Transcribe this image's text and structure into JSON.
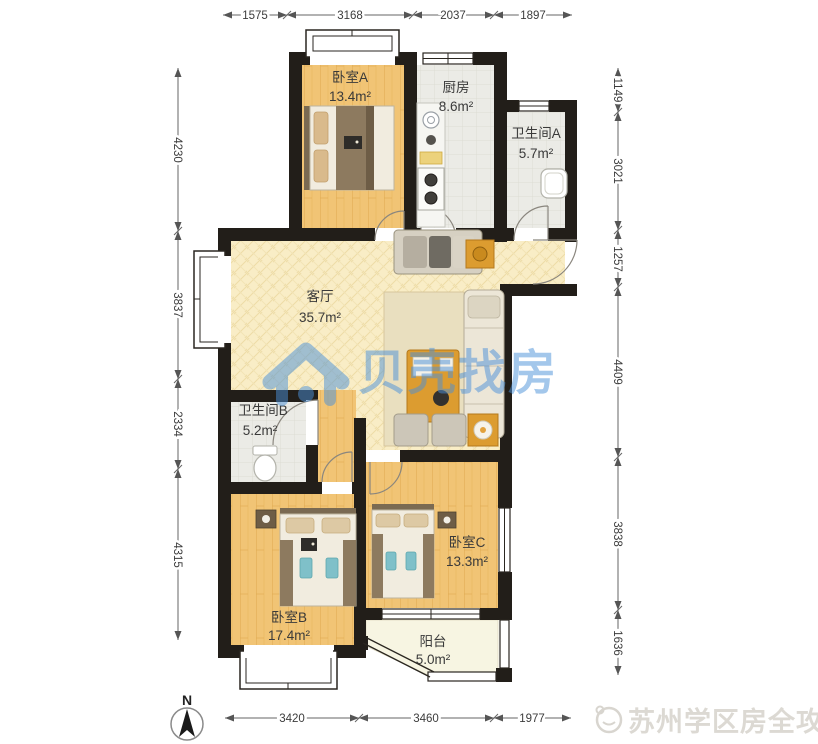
{
  "plan": {
    "rooms": [
      {
        "id": "bedroom-a",
        "name": "卧室A",
        "area": "13.4m²"
      },
      {
        "id": "kitchen",
        "name": "厨房",
        "area": "8.6m²"
      },
      {
        "id": "bathroom-a",
        "name": "卫生间A",
        "area": "5.7m²"
      },
      {
        "id": "living-room",
        "name": "客厅",
        "area": "35.7m²"
      },
      {
        "id": "bathroom-b",
        "name": "卫生间B",
        "area": "5.2m²"
      },
      {
        "id": "bedroom-b",
        "name": "卧室B",
        "area": "17.4m²"
      },
      {
        "id": "bedroom-c",
        "name": "卧室C",
        "area": "13.3m²"
      },
      {
        "id": "balcony",
        "name": "阳台",
        "area": "5.0m²"
      }
    ],
    "dims": {
      "top": [
        "1575",
        "3168",
        "2037",
        "1897"
      ],
      "bottom": [
        "3420",
        "3460",
        "1977"
      ],
      "left": [
        "4230",
        "3837",
        "2334",
        "4315"
      ],
      "right": [
        "1149",
        "3021",
        "1257",
        "4409",
        "3838",
        "1636"
      ]
    },
    "compass_label": "N",
    "watermark": {
      "text": "贝壳找房",
      "color": "#4a90d9"
    },
    "footer": {
      "text": "苏州学区房全攻略",
      "color": "#d9d6d0"
    },
    "colors": {
      "wall": "#221e19",
      "wood_floor": "#f2c678",
      "living_floor": "#f9edc6",
      "tile_floor": "#ebebe7",
      "balcony_floor": "#f7f5e2",
      "accent_teal": "#7fc0c9",
      "accent_orange": "#e2a23e"
    }
  }
}
